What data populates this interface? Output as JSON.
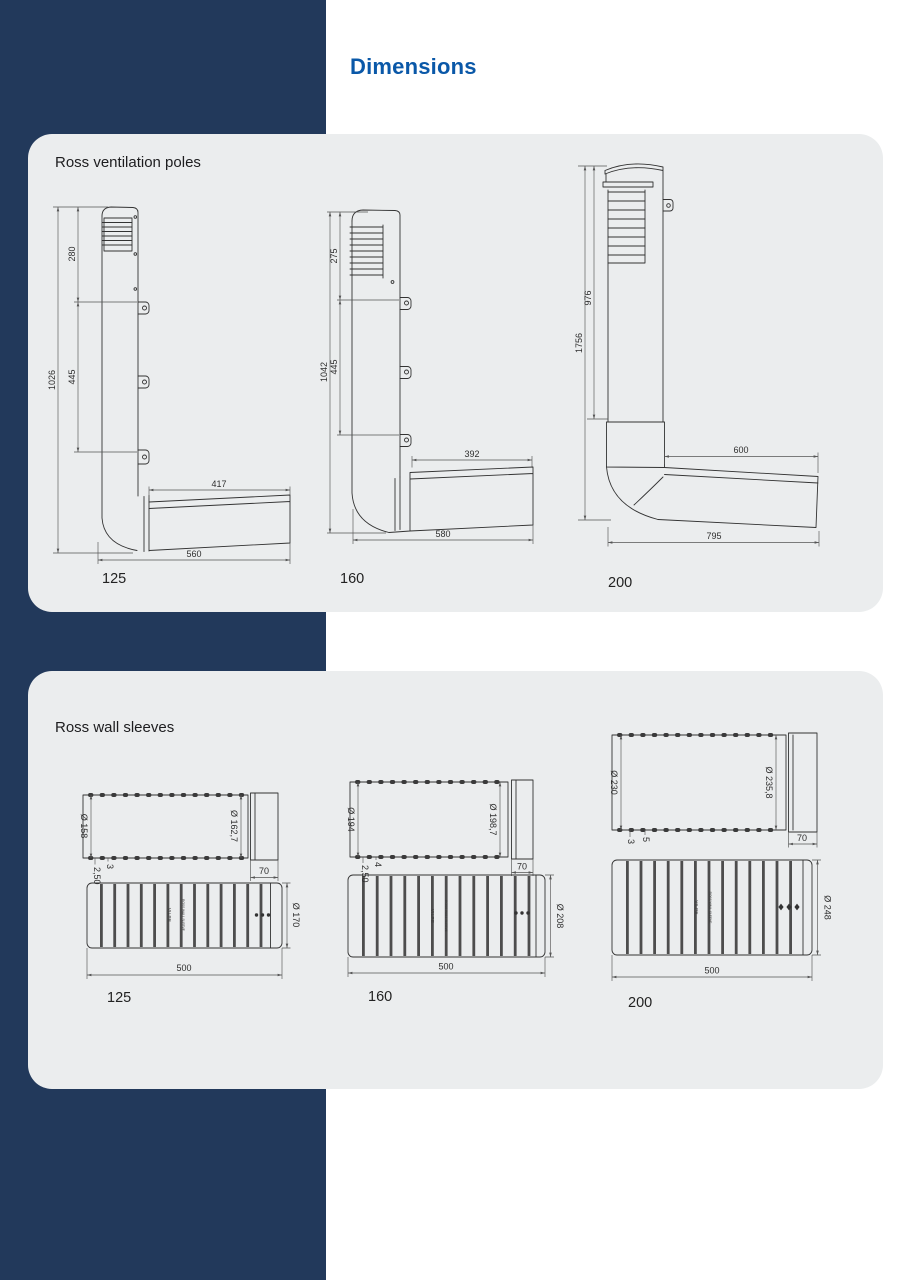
{
  "page": {
    "title": "Dimensions"
  },
  "colors": {
    "accent": "#0a58a8",
    "navy": "#22395b",
    "card": "#ebedee",
    "line": "#333333"
  },
  "sections": [
    {
      "title": "Ross ventilation poles",
      "drawings": [
        {
          "size_label": "125",
          "dims": {
            "total_height": "1026",
            "upper": "280",
            "lower": "445",
            "duct_top": "417",
            "duct_bottom": "560"
          }
        },
        {
          "size_label": "160",
          "dims": {
            "total_height": "1042",
            "upper": "275",
            "lower": "445",
            "duct_top": "392",
            "duct_bottom": "580"
          }
        },
        {
          "size_label": "200",
          "dims": {
            "total_height": "1756",
            "upper": "976",
            "duct_top": "600",
            "duct_bottom": "795"
          }
        }
      ]
    },
    {
      "title": "Ross wall sleeves",
      "drawings": [
        {
          "size_label": "125",
          "dims": {
            "pipe_diameter": "Ø 158",
            "collar_diameter": "Ø 162,7",
            "collar_length": "70",
            "wall_thickness": "2,50",
            "rib_height": "3",
            "outer_diameter": "Ø 170",
            "length": "500"
          },
          "markings": {
            "brand": "VILPE",
            "text": "ROSS WALL SLEEVE"
          }
        },
        {
          "size_label": "160",
          "dims": {
            "pipe_diameter": "Ø 194",
            "collar_diameter": "Ø 198,7",
            "collar_length": "70",
            "wall_thickness": "2,50",
            "rib_height": "4",
            "outer_diameter": "Ø 208",
            "length": "500"
          },
          "markings": {
            "brand": "VILPE",
            "text": "ROSS WALL SLEEVE"
          }
        },
        {
          "size_label": "200",
          "dims": {
            "pipe_diameter": "Ø 230",
            "collar_diameter": "Ø 235,8",
            "collar_length": "70",
            "wall_thickness": "3",
            "rib_height": "5",
            "outer_diameter": "Ø 248",
            "length": "500"
          },
          "markings": {
            "brand": "VILPE",
            "text": "ROSS WALL SLEEVE"
          }
        }
      ]
    }
  ]
}
